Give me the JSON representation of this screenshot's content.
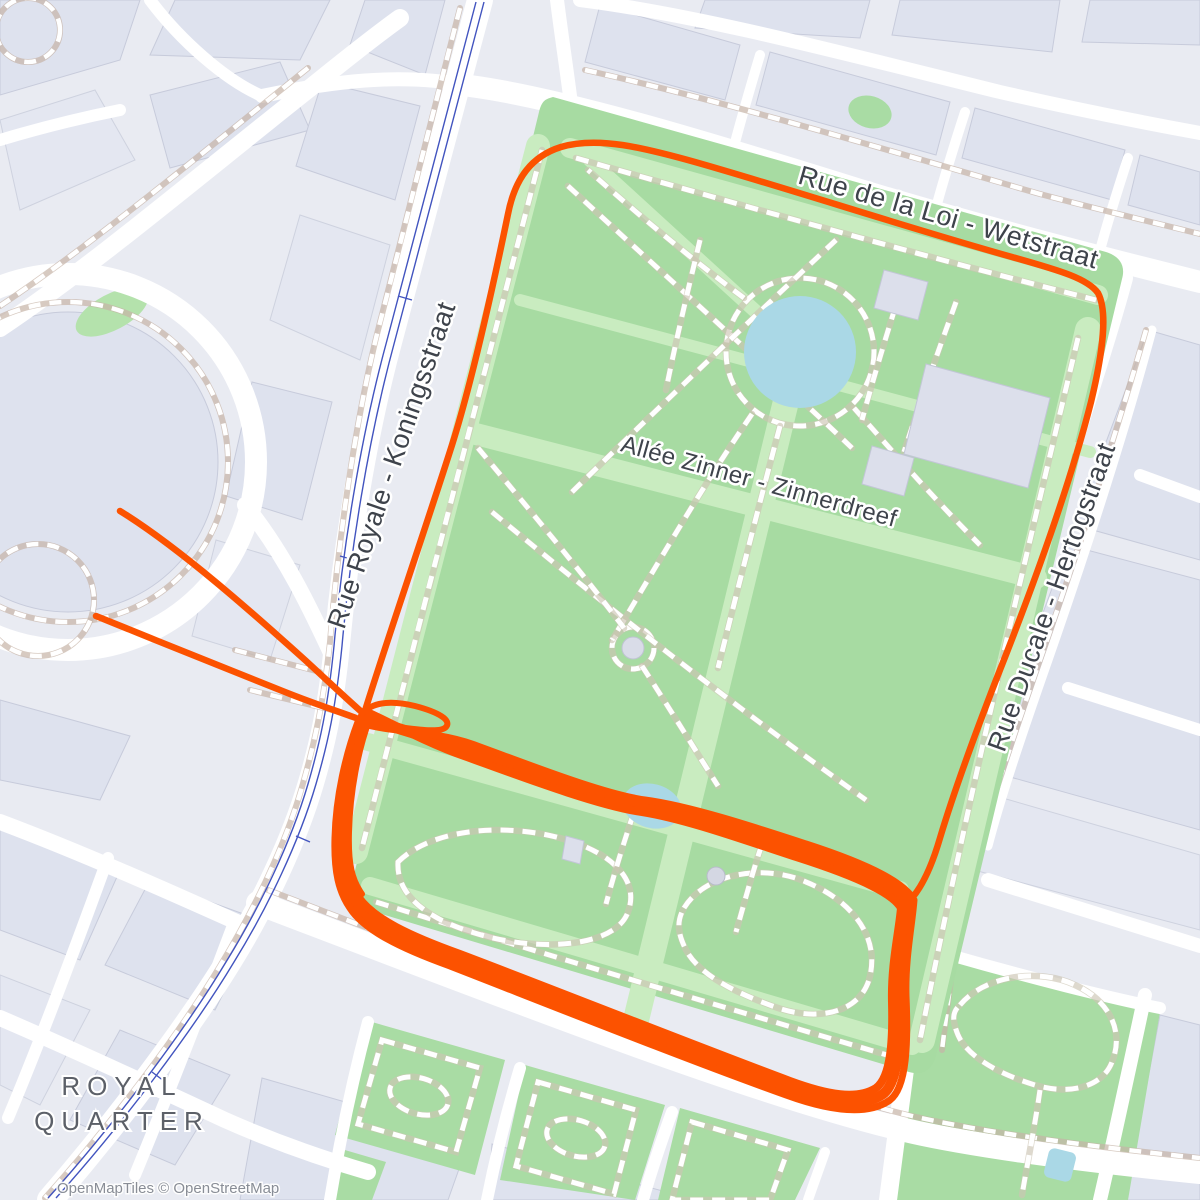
{
  "map": {
    "streets": {
      "top": "Rue de la Loi - Wetstraat",
      "west": "Rue Royale - Koningsstraat",
      "park": "Allée Zinner - Zinnerdreef",
      "east": "Rue Ducale - Hertogstraat"
    },
    "district": {
      "line1": "ROYAL",
      "line2": "QUARTER"
    },
    "attribution": "OpenMapTiles © OpenStreetMap",
    "colors": {
      "route": "#fc5200",
      "park_green": "#a7dba2",
      "allee_green": "#c9ecc0",
      "water": "#aad8e6",
      "railway": "#4254bf",
      "background": "#e9ebf2",
      "building": "#dee2ee"
    },
    "route": {
      "tail1_d": "M 120 511 C 180 548 255 615 305 660 C 330 683 350 702 364 714",
      "tail2_d": "M 96 616 C 160 642 235 672 285 692 C 315 704 340 712 356 718",
      "big_loop_d": "M 364 714 C 382 655 425 530 452 445 C 474 375 496 272 508 214 C 515 178 532 156 561 147 C 598 136 645 148 695 162 C 790 189 905 227 1012 257 C 1062 271 1088 279 1098 293 C 1108 312 1103 352 1091 402 C 1068 492 1031 592 996 680 C 972 742 952 798 940 838 C 933 862 924 884 912 898",
      "loop_main_d": "M 363 716 C 351 748 341 792 340 836 C 339 870 343 888 354 903 C 368 925 404 942 454 960 C 544 995 692 1053 788 1088 C 830 1103 863 1108 883 1094 C 899 1082 900 1040 898 998 C 897 960 906 928 908 903 C 899 888 868 872 800 850 C 748 833 688 812 643 806 C 600 800 518 768 468 750 C 428 736 388 726 363 716 Z",
      "loop_strand2_d": "M 367 712 C 357 744 347 790 346 834 C 345 868 349 884 359 898 C 374 919 410 936 460 954 C 550 988 696 1046 790 1081 C 828 1095 857 1100 876 1088 C 891 1077 893 1040 892 1002 C 891 964 899 932 901 908 C 893 894 862 878 796 857 C 744 840 686 819 642 812 C 598 806 514 774 464 756 C 424 742 390 722 367 712 Z",
      "loop_strand3_d": "M 358 722 C 346 754 336 796 335 838 C 334 872 339 892 350 908 C 364 930 400 948 450 966 C 540 1001 688 1060 786 1095 C 830 1111 868 1116 890 1100 C 907 1087 908 1042 906 996 C 905 958 912 926 914 900 C 905 884 874 866 806 844 C 754 827 690 806 645 800 C 602 794 522 762 472 744 C 432 730 384 732 358 722 Z",
      "hook_d": "M 362 714 C 372 702 390 700 415 706 C 438 712 452 720 446 727 C 440 734 410 728 388 726",
      "strand_left_d": "M 370 718 C 358 750 350 792 349 832 C 348 864 352 880 362 894",
      "strand_top_d": "M 370 722 C 430 742 500 760 560 780 C 610 796 640 806 660 810"
    }
  }
}
